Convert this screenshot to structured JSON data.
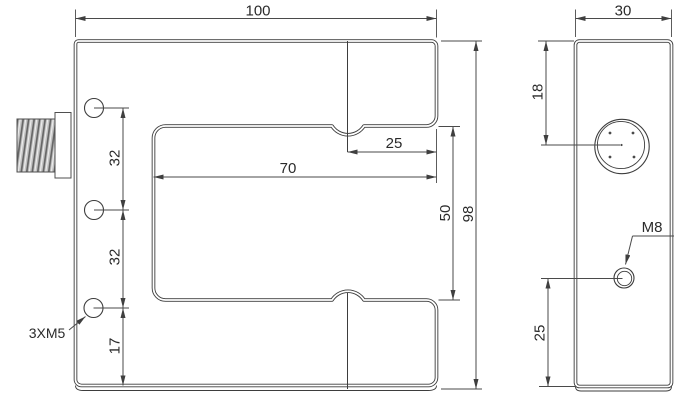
{
  "colors": {
    "background": "#ffffff",
    "line": "#3d3d3d",
    "dim_line": "#4a4a4a",
    "text": "#2b2b2b",
    "thread_base": "#c3c3c3",
    "thread_dark": "#636363"
  },
  "front_view": {
    "width_label": "100",
    "height_label": "98",
    "slot_depth_label": "70",
    "axis_to_mouth_label": "25",
    "slot_gap_label": "50",
    "hole_pitch_upper_label": "32",
    "hole_pitch_lower_label": "32",
    "bottom_hole_offset_label": "17",
    "mounting_holes_label": "3XM5"
  },
  "side_view": {
    "depth_label": "30",
    "lens_offset_label": "18",
    "m8_offset_label": "25",
    "m8_hole_label": "M8"
  }
}
